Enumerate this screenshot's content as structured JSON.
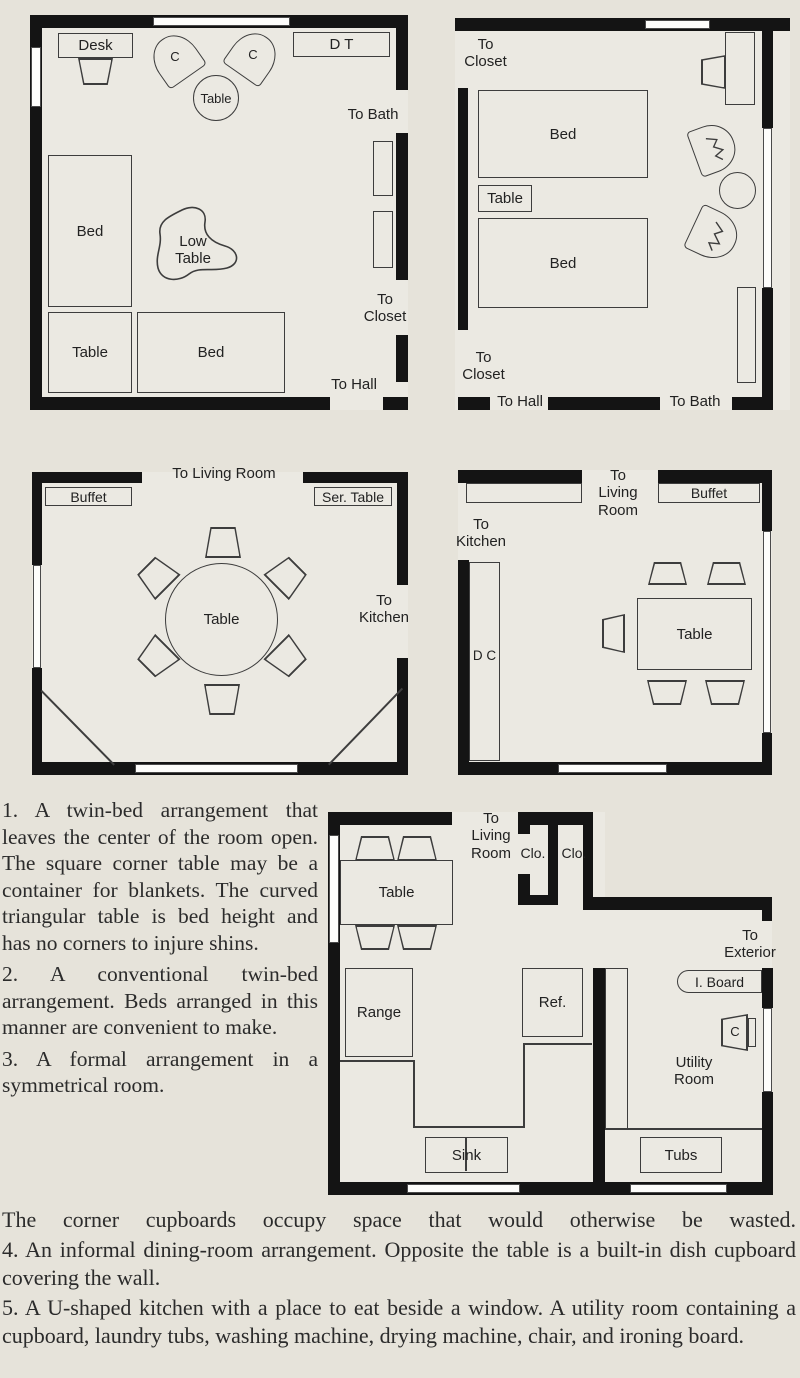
{
  "colors": {
    "page_bg": "#e6e3da",
    "floor": "#ebe9e2",
    "wall": "#141414",
    "furniture_line": "#3d3d3d",
    "text_ink": "#2b2b2b"
  },
  "plans": {
    "p1": {
      "desk": "Desk",
      "chair_c1": "C",
      "chair_c2": "C",
      "center_table": "Table",
      "dressing_table": "D T",
      "to_bath": "To Bath",
      "bed_left": "Bed",
      "low_table": "Low Table",
      "corner_table": "Table",
      "bed_bottom": "Bed",
      "to_closet": "To Closet",
      "to_hall": "To Hall"
    },
    "p2": {
      "to_closet_top": "To Closet",
      "bed_top": "Bed",
      "table": "Table",
      "bed_bottom": "Bed",
      "to_closet_bottom": "To Closet",
      "to_hall": "To Hall",
      "to_bath": "To Bath"
    },
    "p3": {
      "buffet": "Buffet",
      "to_living_room": "To Living Room",
      "serving_table": "Ser. Table",
      "table": "Table",
      "to_kitchen": "To Kitchen"
    },
    "p4": {
      "to_living_room": "To Living Room",
      "buffet": "Buffet",
      "to_kitchen": "To Kitchen",
      "dish_cupboard": "D C",
      "table": "Table"
    },
    "p5": {
      "to_living_room": "To Living Room",
      "closet_left": "Clo.",
      "closet_right": "Clo.",
      "table": "Table",
      "range": "Range",
      "refrigerator": "Ref.",
      "sink": "Sink",
      "to_exterior": "To Exterior",
      "ironing_board": "I. Board",
      "chair": "C",
      "utility_room": "Utility Room",
      "tubs": "Tubs"
    }
  },
  "captions": {
    "para1": "1.  A twin-bed arrangement that leaves the center of the room open.  The square corner table may be a container for blankets.  The curved triangular table is bed height and has no corners to injure shins.",
    "para2": "2.  A conventional twin-bed arrangement.  Beds arranged in this manner are convenient to make.",
    "para3_col": "3.  A formal arrangement in a symmetrical room.",
    "para3_cont": "The corner cupboards occupy space that would otherwise be wasted.",
    "para4": "4.  An informal dining-room arrangement.  Opposite the table is a built-in dish cupboard covering the wall.",
    "para5": "5.  A U-shaped kitchen with a place to eat beside a window.  A utility room containing a cupboard, laundry tubs, washing machine, drying machine, chair, and ironing board."
  }
}
